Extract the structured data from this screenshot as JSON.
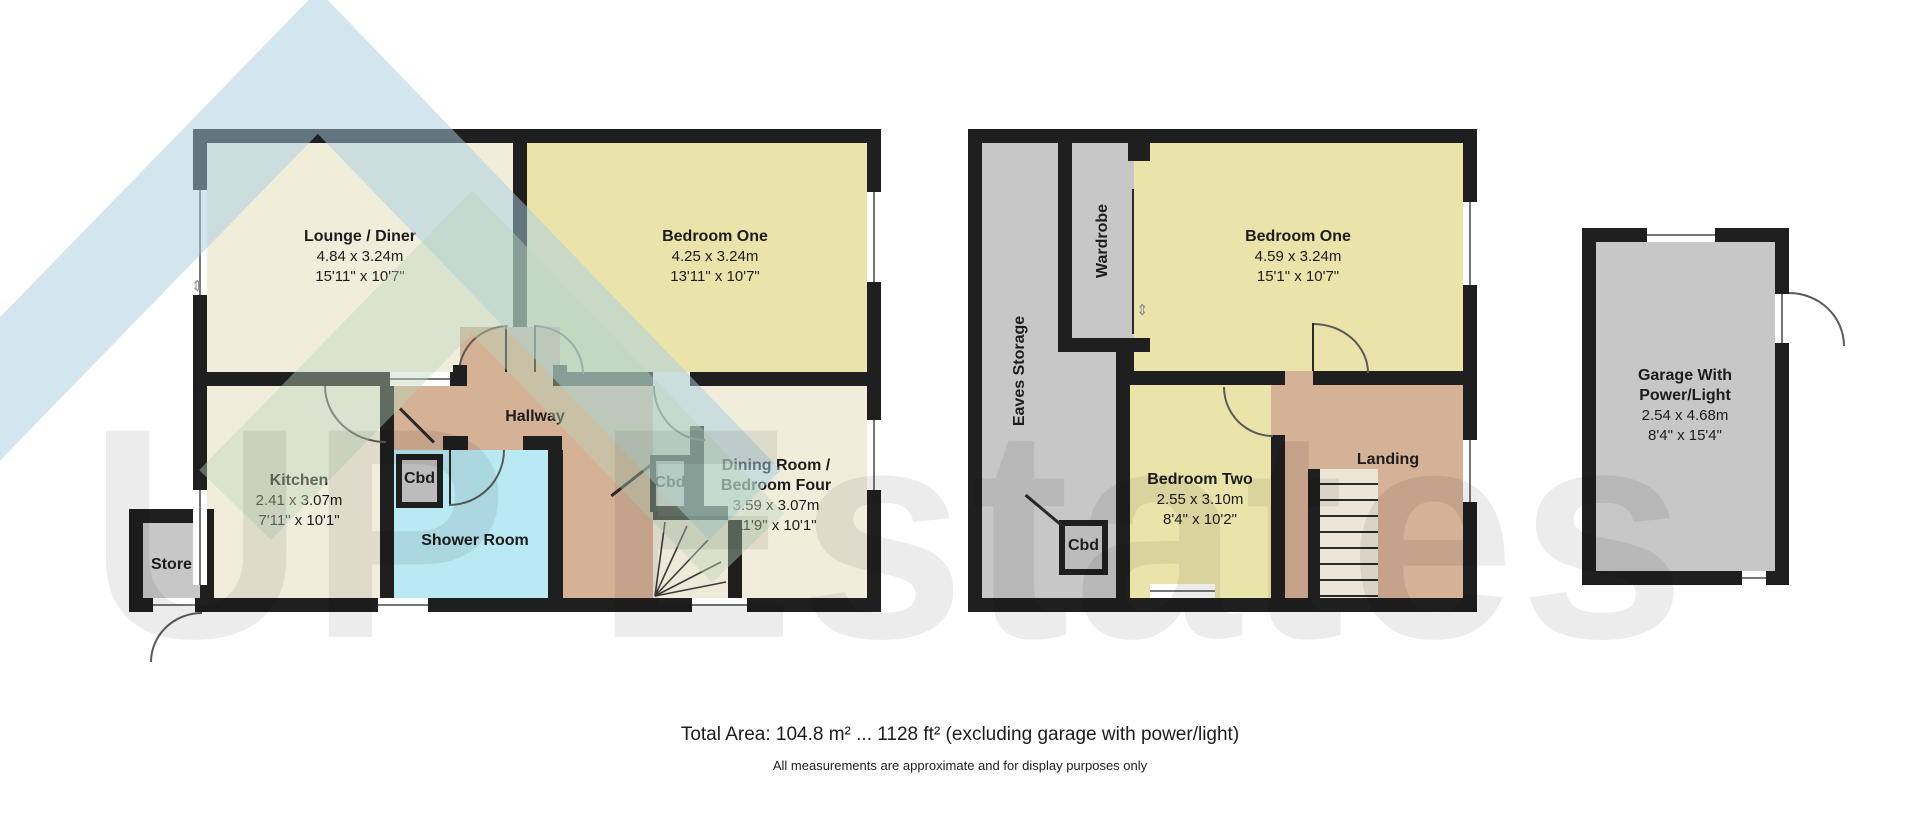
{
  "watermark": {
    "text": "UP Estates"
  },
  "colors": {
    "wall": "#1f1f1f",
    "room_cream": "#f0eddb",
    "room_yellow": "#ebe4aa",
    "room_tan": "#d5b196",
    "room_cyan": "#b9e9f2",
    "room_gray": "#c7c7c7",
    "cupboard_gray": "#bcbcbc"
  },
  "ground": {
    "lounge": {
      "name": "Lounge / Diner",
      "metric": "4.84 x 3.24m",
      "imperial": "15'11\" x 10'7\""
    },
    "bedroom_one": {
      "name": "Bedroom One",
      "metric": "4.25 x 3.24m",
      "imperial": "13'11\" x 10'7\""
    },
    "kitchen": {
      "name": "Kitchen",
      "metric": "2.41 x 3.07m",
      "imperial": "7'11\" x 10'1\""
    },
    "hallway": {
      "name": "Hallway"
    },
    "shower": {
      "name": "Shower Room"
    },
    "store": {
      "name": "Store"
    },
    "cbd1": {
      "name": "Cbd"
    },
    "cbd2": {
      "name": "Cbd"
    },
    "dining": {
      "name_line1": "Dining Room /",
      "name_line2": "Bedroom Four",
      "metric": "3.59 x 3.07m",
      "imperial": "11'9\" x 10'1\""
    }
  },
  "first": {
    "eaves": {
      "name": "Eaves Storage"
    },
    "wardrobe": {
      "name": "Wardrobe"
    },
    "bedroom_one": {
      "name": "Bedroom One",
      "metric": "4.59 x 3.24m",
      "imperial": "15'1\" x 10'7\""
    },
    "bedroom_two": {
      "name": "Bedroom Two",
      "metric": "2.55 x 3.10m",
      "imperial": "8'4\" x 10'2\""
    },
    "landing": {
      "name": "Landing"
    },
    "cbd": {
      "name": "Cbd"
    }
  },
  "garage": {
    "name_line1": "Garage With",
    "name_line2": "Power/Light",
    "metric": "2.54 x 4.68m",
    "imperial": "8'4\" x 15'4\""
  },
  "footer": {
    "total_area": "Total Area: 104.8 m² ... 1128 ft² (excluding garage with power/light)",
    "disclaimer": "All measurements are approximate and for display purposes only"
  }
}
